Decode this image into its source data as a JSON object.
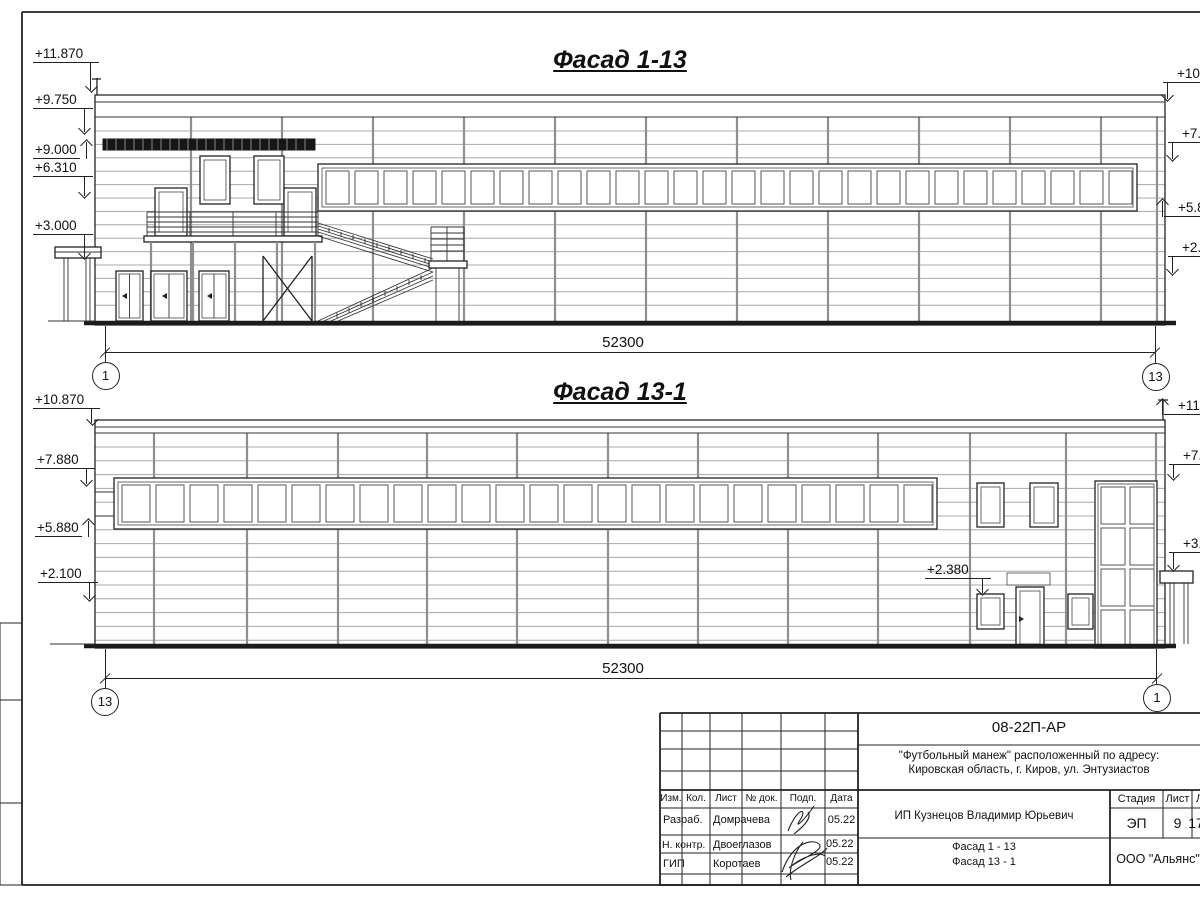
{
  "sheet": {
    "facade1": {
      "title": "Фасад 1-13",
      "elev_left": [
        "+11.870",
        "+9.750",
        "+9.000",
        "+6.310",
        "+3.000"
      ],
      "elev_right": [
        "+10.8",
        "+7.8",
        "+5.8",
        "+2.1"
      ],
      "dim": "52300",
      "axis_left": "1",
      "axis_right": "13"
    },
    "facade2": {
      "title": "Фасад 13-1",
      "elev_left": [
        "+10.870",
        "+7.880",
        "+5.880",
        "+2.100"
      ],
      "elev_right": [
        "+11.8",
        "+7.8",
        "+3.0"
      ],
      "inner_mark": "+2.380",
      "dim": "52300",
      "axis_left": "13",
      "axis_right": "1"
    },
    "title_block": {
      "doc_number": "08-22П-АР",
      "project_line1": "\"Футбольный манеж\" расположенный по адресу:",
      "project_line2": "Кировская область, г. Киров, ул. Энтузиастов",
      "header": {
        "izm": "Изм.",
        "kol": "Кол.",
        "list": "Лист",
        "doc": "№ док.",
        "podp": "Подп.",
        "data": "Дата"
      },
      "rows": [
        {
          "role": "Разраб.",
          "name": "Домрачева",
          "date": "05.22"
        },
        {
          "role": "Н. контр.",
          "name": "Двоеглазов",
          "date": "05.22"
        },
        {
          "role": "ГИП",
          "name": "Коротаев",
          "date": "05.22"
        }
      ],
      "customer": "ИП Кузнецов Владимир Юрьевич",
      "stage_label": "Стадия",
      "stage": "ЭП",
      "sheet_label": "Лист",
      "sheet_no": "9",
      "sheets_label": "Листов",
      "sheets_total": "17",
      "drawing_names": [
        "Фасад 1 - 13",
        "Фасад 13 - 1"
      ],
      "organization": "ООО \"Альянс\""
    }
  }
}
